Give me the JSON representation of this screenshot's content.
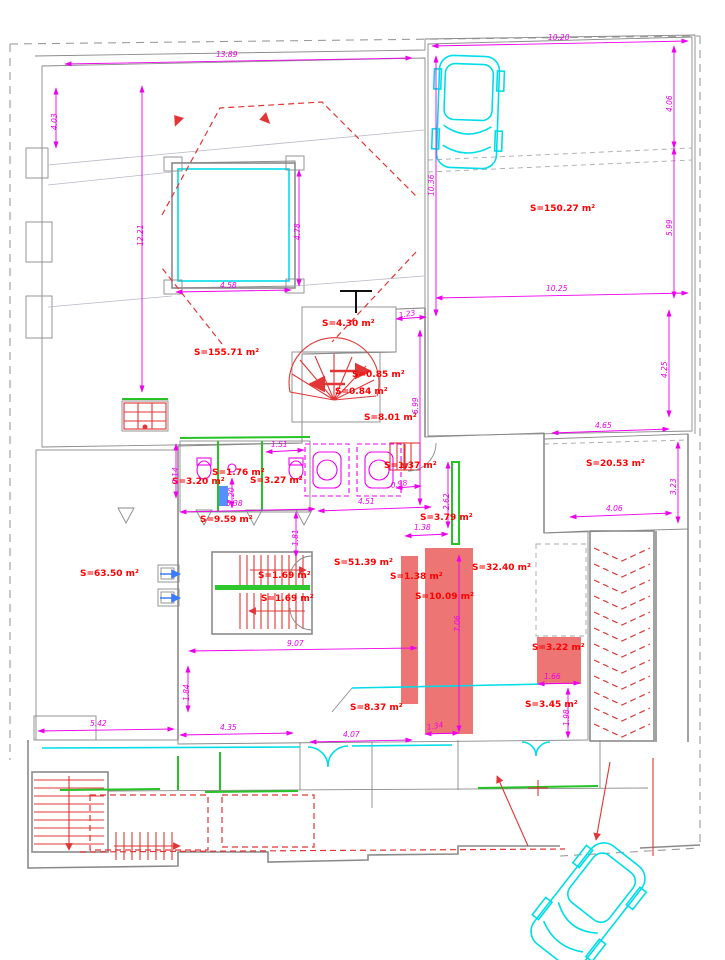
{
  "title": "Ground floor plan with surface areas",
  "colors": {
    "blue": "#7a79dd",
    "orange": "#f4b780",
    "yellow": "#f8f37d",
    "red_room": "#ed7573",
    "cyan_room": "#bceef6",
    "dim": "#ee00ee",
    "annotation": "#ff0000",
    "wall": "#8a8a8a",
    "green": "#26c226",
    "cyan_line": "#00dde8",
    "stair_red": "#e03636"
  },
  "labels": {
    "areas": [
      {
        "text": "S=155.71 m²",
        "x": 194,
        "y": 348
      },
      {
        "text": "S=150.27 m²",
        "x": 530,
        "y": 204
      },
      {
        "text": "S=4.30 m²",
        "x": 322,
        "y": 319
      },
      {
        "text": "S=0.85 m²",
        "x": 352,
        "y": 370
      },
      {
        "text": "S=0.84 m²",
        "x": 335,
        "y": 387
      },
      {
        "text": "S=8.01 m²",
        "x": 364,
        "y": 413
      },
      {
        "text": "S=3.20 m²",
        "x": 172,
        "y": 477
      },
      {
        "text": "S=1.76 m²",
        "x": 212,
        "y": 468
      },
      {
        "text": "S=3.27 m²",
        "x": 250,
        "y": 476
      },
      {
        "text": "S=1.37 m²",
        "x": 384,
        "y": 461
      },
      {
        "text": "S=9.59 m²",
        "x": 200,
        "y": 515
      },
      {
        "text": "S=3.79 m²",
        "x": 420,
        "y": 513
      },
      {
        "text": "S=63.50 m²",
        "x": 80,
        "y": 569
      },
      {
        "text": "S=1.69 m²",
        "x": 258,
        "y": 571
      },
      {
        "text": "S=1.69 m²",
        "x": 261,
        "y": 594
      },
      {
        "text": "S=51.39 m²",
        "x": 334,
        "y": 558
      },
      {
        "text": "S=1.38 m²",
        "x": 390,
        "y": 572
      },
      {
        "text": "S=10.09 m²",
        "x": 415,
        "y": 592
      },
      {
        "text": "S=32.40 m²",
        "x": 472,
        "y": 563
      },
      {
        "text": "S=20.53 m²",
        "x": 586,
        "y": 459
      },
      {
        "text": "S=3.22 m²",
        "x": 532,
        "y": 643
      },
      {
        "text": "S=3.45 m²",
        "x": 525,
        "y": 700
      },
      {
        "text": "S=8.37 m²",
        "x": 350,
        "y": 703
      }
    ],
    "dims": [
      {
        "text": "13.89",
        "x": 216,
        "y": 50
      },
      {
        "text": "12.21",
        "x": 136,
        "y": 246,
        "r": -90
      },
      {
        "text": "4.03",
        "x": 50,
        "y": 130,
        "r": -90
      },
      {
        "text": "4.58",
        "x": 220,
        "y": 281
      },
      {
        "text": "4.78",
        "x": 293,
        "y": 240,
        "r": -90
      },
      {
        "text": "10.20",
        "x": 548,
        "y": 33
      },
      {
        "text": "10.36",
        "x": 427,
        "y": 196,
        "r": -90
      },
      {
        "text": "4.06",
        "x": 665,
        "y": 112,
        "r": -90
      },
      {
        "text": "5.99",
        "x": 665,
        "y": 236,
        "r": -90
      },
      {
        "text": "10.25",
        "x": 546,
        "y": 284
      },
      {
        "text": "4.25",
        "x": 660,
        "y": 378,
        "r": -90
      },
      {
        "text": "1.23",
        "x": 398,
        "y": 311,
        "r": -10
      },
      {
        "text": "6.99",
        "x": 411,
        "y": 414,
        "r": -90
      },
      {
        "text": "4.65",
        "x": 595,
        "y": 421
      },
      {
        "text": "4.06",
        "x": 606,
        "y": 504
      },
      {
        "text": "3.23",
        "x": 669,
        "y": 495,
        "r": -90
      },
      {
        "text": "1.51",
        "x": 271,
        "y": 440
      },
      {
        "text": "2.14",
        "x": 171,
        "y": 484,
        "r": -90
      },
      {
        "text": "1.20",
        "x": 227,
        "y": 504,
        "r": -90
      },
      {
        "text": "5.38",
        "x": 226,
        "y": 499
      },
      {
        "text": "4.51",
        "x": 358,
        "y": 497
      },
      {
        "text": "0.98",
        "x": 390,
        "y": 481,
        "r": -10
      },
      {
        "text": "1.81",
        "x": 291,
        "y": 546,
        "r": -90
      },
      {
        "text": "1.38",
        "x": 414,
        "y": 523
      },
      {
        "text": "2.62",
        "x": 442,
        "y": 510,
        "r": -90
      },
      {
        "text": "7.06",
        "x": 453,
        "y": 632,
        "r": -90
      },
      {
        "text": "9.07",
        "x": 287,
        "y": 639
      },
      {
        "text": "5.42",
        "x": 90,
        "y": 719
      },
      {
        "text": "1.84",
        "x": 182,
        "y": 701,
        "r": -90
      },
      {
        "text": "4.35",
        "x": 220,
        "y": 723
      },
      {
        "text": "4.07",
        "x": 343,
        "y": 730
      },
      {
        "text": "1.34",
        "x": 426,
        "y": 723,
        "r": -10
      },
      {
        "text": "1.66",
        "x": 544,
        "y": 672
      },
      {
        "text": "1.98",
        "x": 562,
        "y": 726,
        "r": -90
      }
    ]
  }
}
